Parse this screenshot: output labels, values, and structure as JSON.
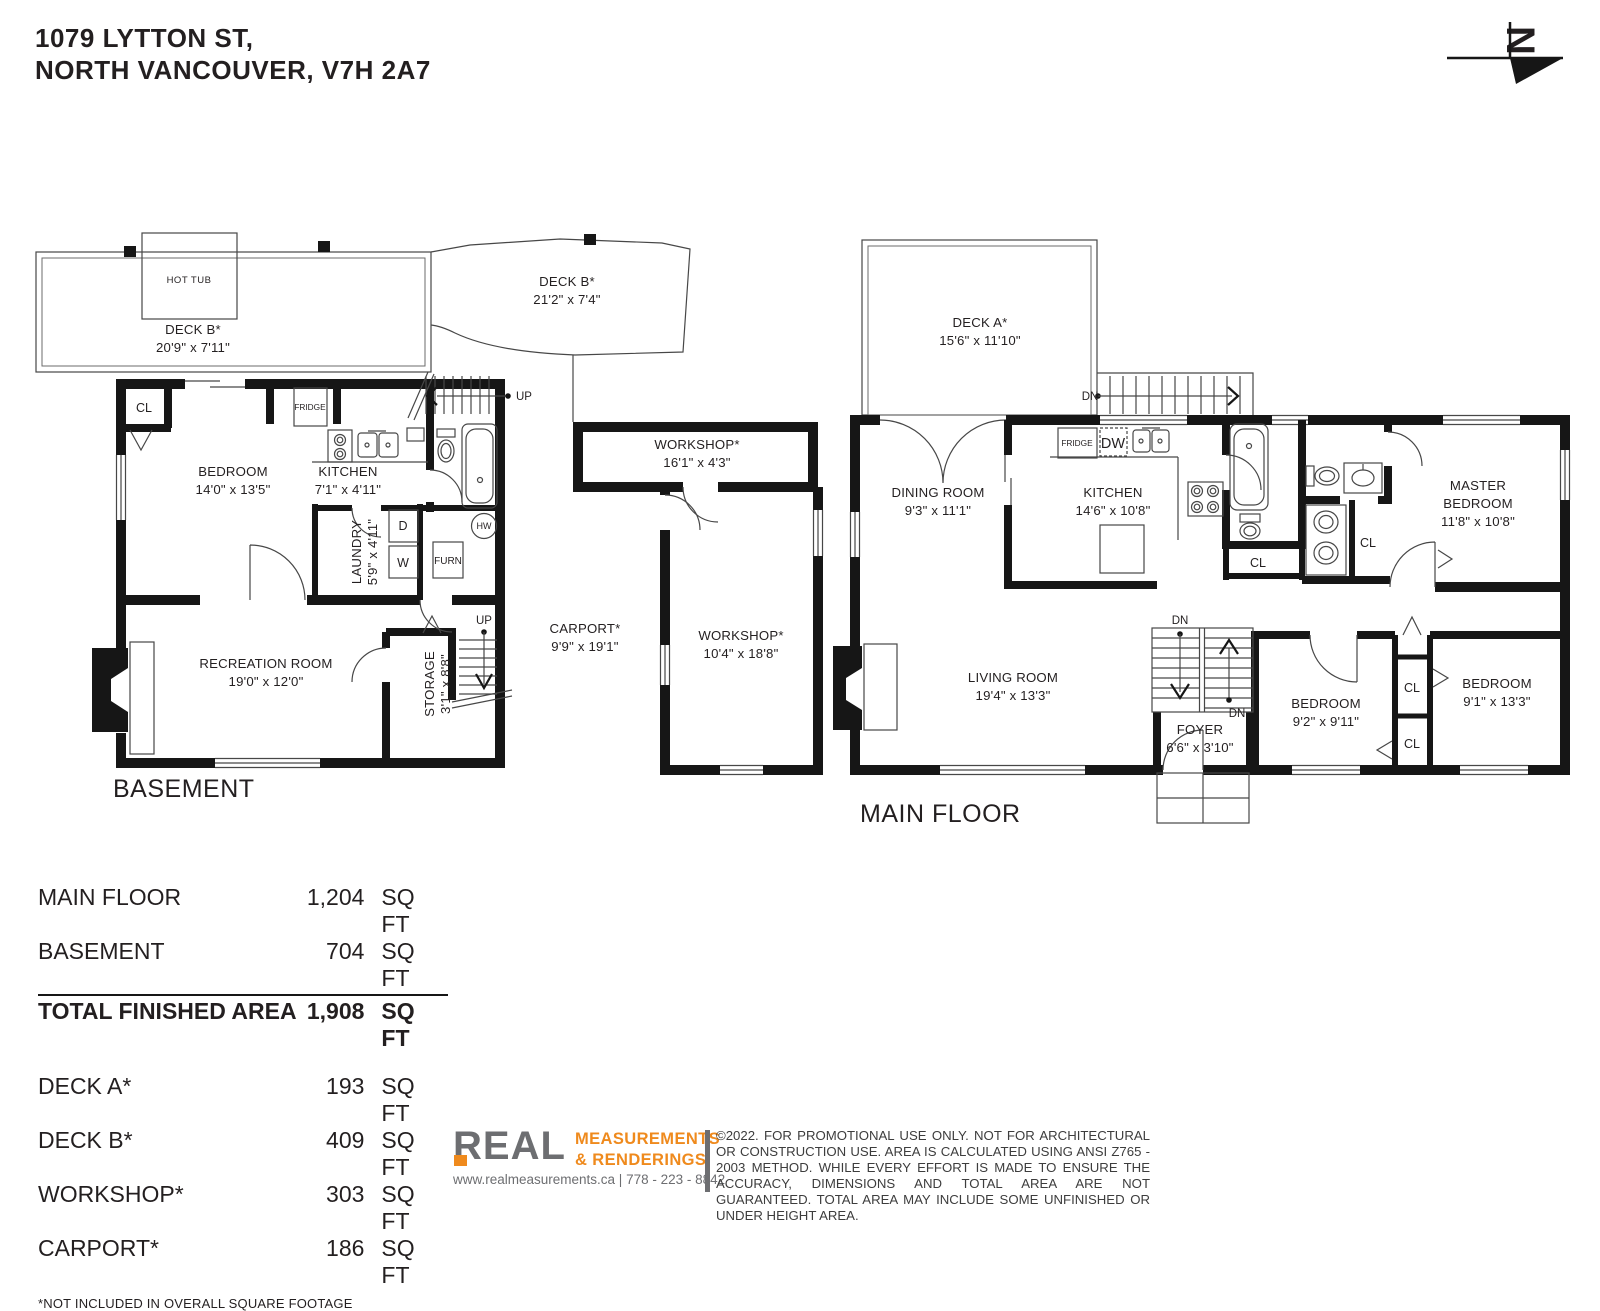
{
  "header": {
    "address_line1": "1079 LYTTON ST,",
    "address_line2": "NORTH VANCOUVER, V7H 2A7"
  },
  "north": {
    "label": "N"
  },
  "basement": {
    "title": "BASEMENT",
    "deck_left": {
      "name": "DECK B*",
      "dims": "20'9\" x 7'11\""
    },
    "deck_right": {
      "name": "DECK B*",
      "dims": "21'2\" x 7'4\""
    },
    "hot_tub": "HOT TUB",
    "closet": "CL",
    "bedroom": {
      "name": "BEDROOM",
      "dims": "14'0\" x 13'5\""
    },
    "kitchen": {
      "name": "KITCHEN",
      "dims": "7'1\" x 4'11\""
    },
    "fridge": "FRIDGE",
    "laundry": {
      "name": "LAUNDRY",
      "dims": "5'9\" x 4'11\""
    },
    "dryer": "D",
    "washer": "W",
    "furnace": "FURN",
    "hot_water": "HW",
    "rec_room": {
      "name": "RECREATION ROOM",
      "dims": "19'0\" x 12'0\""
    },
    "storage": {
      "name": "STORAGE",
      "dims": "3'1\" x 8'8\""
    },
    "up_top": "UP",
    "up_bottom": "UP"
  },
  "outbuildings": {
    "workshop_top": {
      "name": "WORKSHOP*",
      "dims": "16'1\" x 4'3\""
    },
    "carport": {
      "name": "CARPORT*",
      "dims": "9'9\" x 19'1\""
    },
    "workshop_main": {
      "name": "WORKSHOP*",
      "dims": "10'4\" x 18'8\""
    }
  },
  "main_floor": {
    "title": "MAIN FLOOR",
    "deck_a": {
      "name": "DECK A*",
      "dims": "15'6\" x 11'10\""
    },
    "dining": {
      "name": "DINING ROOM",
      "dims": "9'3\" x 11'1\""
    },
    "kitchen": {
      "name": "KITCHEN",
      "dims": "14'6\" x 10'8\""
    },
    "fridge": "FRIDGE",
    "dishwasher": "DW",
    "master": {
      "line1": "MASTER",
      "line2": "BEDROOM",
      "dims": "11'8\" x 10'8\""
    },
    "living": {
      "name": "LIVING ROOM",
      "dims": "19'4\" x 13'3\""
    },
    "foyer": {
      "name": "FOYER",
      "dims": "6'6\" x 3'10\""
    },
    "bedroom1": {
      "name": "BEDROOM",
      "dims": "9'2\" x 9'11\""
    },
    "bedroom2": {
      "name": "BEDROOM",
      "dims": "9'1\" x 13'3\""
    },
    "cl_hall": "CL",
    "cl_master": "CL",
    "cl_bed1": "CL",
    "cl_bed2": "CL",
    "dn_deck": "DN",
    "dn_stair_top": "DN",
    "dn_stair_bottom": "DN"
  },
  "areas": {
    "rows": [
      {
        "label": "MAIN FLOOR",
        "value": "1,204",
        "unit": "SQ FT"
      },
      {
        "label": "BASEMENT",
        "value": "704",
        "unit": "SQ FT"
      },
      {
        "label": "TOTAL FINISHED AREA",
        "value": "1,908",
        "unit": "SQ FT"
      },
      {
        "label": "DECK A*",
        "value": "193",
        "unit": "SQ FT"
      },
      {
        "label": "DECK B*",
        "value": "409",
        "unit": "SQ FT"
      },
      {
        "label": "WORKSHOP*",
        "value": "303",
        "unit": "SQ FT"
      },
      {
        "label": "CARPORT*",
        "value": "186",
        "unit": "SQ FT"
      }
    ],
    "footnote": "*NOT INCLUDED IN OVERALL SQUARE FOOTAGE"
  },
  "footer": {
    "logo_word": "REAL",
    "tagline_line1": "MEASUREMENTS",
    "tagline_line2": "&  RENDERINGS",
    "url_phone": "www.realmeasurements.ca | 778 - 223 - 8842",
    "disclaimer": "©2022. FOR PROMOTIONAL USE ONLY. NOT FOR ARCHITECTURAL OR CONSTRUCTION USE. AREA IS CALCULATED USING ANSI Z765 - 2003 METHOD. WHILE EVERY EFFORT IS MADE TO ENSURE THE ACCURACY, DIMENSIONS AND TOTAL AREA ARE NOT GUARANTEED. TOTAL AREA MAY INCLUDE SOME UNFINISHED OR UNDER HEIGHT AREA."
  },
  "colors": {
    "ink": "#231F20",
    "wall": "#161616",
    "orange": "#EF8A1D",
    "gray": "#6D6E71"
  }
}
